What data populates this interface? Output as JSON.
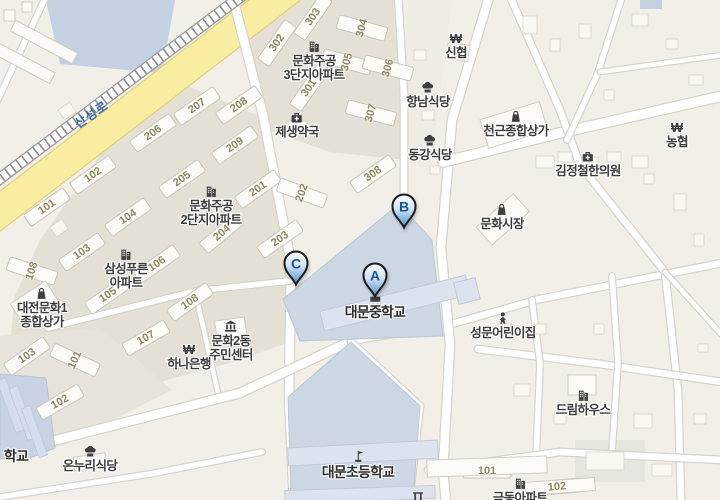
{
  "map": {
    "road_name": "산성로",
    "colors": {
      "land": "#f2efe9",
      "complex_ground": "#e4e0d6",
      "water": "#c3d1e2",
      "school_area": "#ccd7e4",
      "school_building": "#dde3ee",
      "road_fill": "#ffffff",
      "road_casing": "#d8d4ca",
      "major_road_fill": "#f8eda0",
      "major_road_casing": "#e2d07e",
      "building_number": "#92865f",
      "road_name_text": "#3a67ad",
      "poi_text": "#3d3d3d",
      "marker_letter": "#15569c",
      "marker_outline": "#1c1c1c",
      "marker_fill_top": "#ffffff",
      "marker_fill_bottom": "#4a8fd3"
    },
    "markers": [
      {
        "label": "A",
        "x": 375,
        "y": 276
      },
      {
        "label": "B",
        "x": 404,
        "y": 207
      },
      {
        "label": "C",
        "x": 296,
        "y": 264
      }
    ],
    "pois": [
      {
        "name": "munhwa-jugong-3danji-apartment",
        "icon": "building",
        "lines": [
          "문화주공",
          "3단지아파트"
        ],
        "x": 314,
        "y": 40
      },
      {
        "name": "jesaeng-pharmacy",
        "icon": "med",
        "lines": [
          "제생약국"
        ],
        "x": 297,
        "y": 111
      },
      {
        "name": "sinhyeop-credit-union",
        "icon": "bank",
        "lines": [
          "신협"
        ],
        "x": 456,
        "y": 32
      },
      {
        "name": "hyangnam-restaurant",
        "icon": "chef",
        "lines": [
          "향남식당"
        ],
        "x": 428,
        "y": 81
      },
      {
        "name": "donggang-restaurant",
        "icon": "chef",
        "lines": [
          "동강식당"
        ],
        "x": 430,
        "y": 134
      },
      {
        "name": "cheongeun-shopping-center",
        "icon": "bag",
        "lines": [
          "천근종합상가"
        ],
        "x": 516,
        "y": 110
      },
      {
        "name": "nonghyup-bank",
        "icon": "bank",
        "lines": [
          "농협"
        ],
        "x": 677,
        "y": 121
      },
      {
        "name": "kimjeongcheol-clinic",
        "icon": "med",
        "lines": [
          "김정철한의원"
        ],
        "x": 588,
        "y": 150
      },
      {
        "name": "munhwa-market",
        "icon": "bag",
        "lines": [
          "문화시장"
        ],
        "x": 502,
        "y": 203
      },
      {
        "name": "munhwa-jugong-2danji-apartment",
        "icon": "building",
        "lines": [
          "문화주공",
          "2단지아파트"
        ],
        "x": 211,
        "y": 185
      },
      {
        "name": "samsung-pureun-apartment",
        "icon": "building",
        "lines": [
          "삼성푸른",
          "아파트"
        ],
        "x": 126,
        "y": 248
      },
      {
        "name": "daejeon-munhwa1-shopping-center",
        "icon": "bag",
        "lines": [
          "대전문화1",
          "종합상가"
        ],
        "x": 42,
        "y": 287
      },
      {
        "name": "daemun-middle-school",
        "icon": "school",
        "lines": [
          "대문중학교"
        ],
        "x": 375,
        "y": 290,
        "school": true
      },
      {
        "name": "seongmun-daycare",
        "icon": "child",
        "lines": [
          "성문어린이집"
        ],
        "x": 503,
        "y": 312
      },
      {
        "name": "munhwa-2dong-community-center",
        "icon": "gov",
        "lines": [
          "문화2동",
          "주민센터"
        ],
        "x": 231,
        "y": 320
      },
      {
        "name": "hana-bank",
        "icon": "bank",
        "lines": [
          "하나은행"
        ],
        "x": 189,
        "y": 343
      },
      {
        "name": "dream-house",
        "icon": "building",
        "lines": [
          "드림하우스"
        ],
        "x": 583,
        "y": 389
      },
      {
        "name": "onnuri-restaurant",
        "icon": "chef",
        "lines": [
          "온누리식당"
        ],
        "x": 90,
        "y": 445
      },
      {
        "name": "daemun-elementary-school",
        "icon": "flag",
        "lines": [
          "대문초등학교"
        ],
        "x": 358,
        "y": 450,
        "school": true
      },
      {
        "name": "geumdong-apartment",
        "icon": "building",
        "lines": [
          "금동아파트"
        ],
        "x": 520,
        "y": 477
      },
      {
        "name": "partial-school-label",
        "icon": "",
        "lines": [
          "학교"
        ],
        "x": 16,
        "y": 449,
        "school": true
      },
      {
        "name": "gate",
        "icon": "gate",
        "lines": [],
        "x": 418,
        "y": 489
      }
    ],
    "building_numbers": [
      {
        "t": "301",
        "x": 309,
        "y": 88,
        "r": -55
      },
      {
        "t": "302",
        "x": 277,
        "y": 43,
        "r": -55
      },
      {
        "t": "303",
        "x": 313,
        "y": 17,
        "r": -55
      },
      {
        "t": "304",
        "x": 362,
        "y": 28,
        "r": -75
      },
      {
        "t": "305",
        "x": 347,
        "y": 62,
        "r": -75
      },
      {
        "t": "306",
        "x": 388,
        "y": 68,
        "r": -75
      },
      {
        "t": "307",
        "x": 371,
        "y": 113,
        "r": -75
      },
      {
        "t": "308",
        "x": 373,
        "y": 174,
        "r": -35
      },
      {
        "t": "201",
        "x": 258,
        "y": 189,
        "r": -35
      },
      {
        "t": "202",
        "x": 302,
        "y": 193,
        "r": -70
      },
      {
        "t": "203",
        "x": 280,
        "y": 239,
        "r": -35
      },
      {
        "t": "204",
        "x": 222,
        "y": 233,
        "r": -40
      },
      {
        "t": "205",
        "x": 182,
        "y": 179,
        "r": -35
      },
      {
        "t": "206",
        "x": 153,
        "y": 133,
        "r": -35
      },
      {
        "t": "207",
        "x": 197,
        "y": 106,
        "r": -35
      },
      {
        "t": "208",
        "x": 239,
        "y": 105,
        "r": -35
      },
      {
        "t": "209",
        "x": 235,
        "y": 145,
        "r": -35
      },
      {
        "t": "101",
        "x": 47,
        "y": 207,
        "r": -35
      },
      {
        "t": "102",
        "x": 93,
        "y": 175,
        "r": -35
      },
      {
        "t": "103",
        "x": 82,
        "y": 252,
        "r": -35
      },
      {
        "t": "104",
        "x": 128,
        "y": 217,
        "r": -35
      },
      {
        "t": "105",
        "x": 108,
        "y": 295,
        "r": -35
      },
      {
        "t": "106",
        "x": 157,
        "y": 264,
        "r": -35
      },
      {
        "t": "107",
        "x": 146,
        "y": 338,
        "r": -30
      },
      {
        "t": "108",
        "x": 32,
        "y": 271,
        "r": -72
      },
      {
        "t": "108",
        "x": 190,
        "y": 302,
        "r": -35
      },
      {
        "t": "103",
        "x": 27,
        "y": 356,
        "r": -35
      },
      {
        "t": "101",
        "x": 75,
        "y": 360,
        "r": -65
      },
      {
        "t": "102",
        "x": 60,
        "y": 402,
        "r": -30
      },
      {
        "t": "101",
        "x": 487,
        "y": 471,
        "r": 0
      },
      {
        "t": "102",
        "x": 557,
        "y": 487,
        "r": -5
      }
    ]
  }
}
